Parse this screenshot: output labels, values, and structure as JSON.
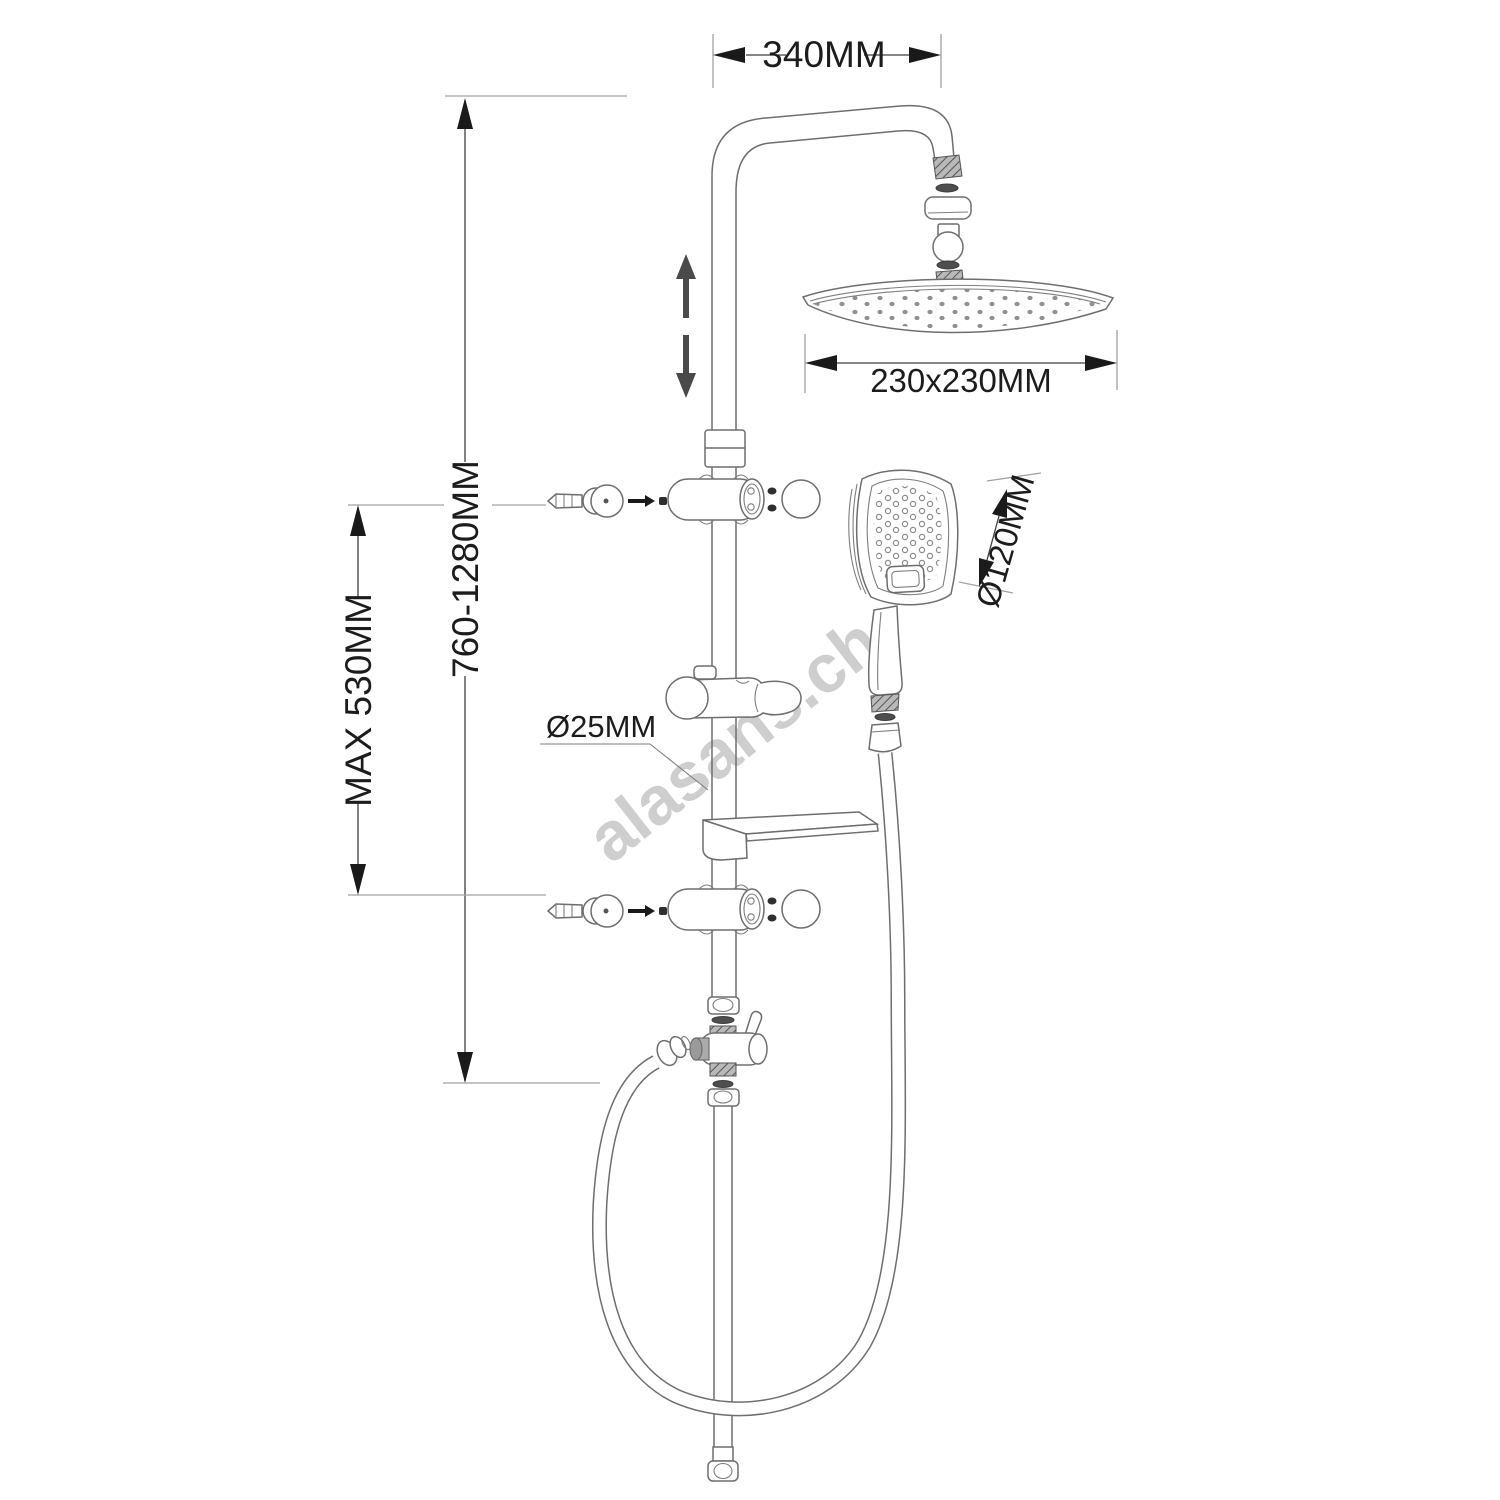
{
  "drawing": {
    "title": "shower-column-technical-drawing",
    "watermark": "alasans.ch",
    "labels": {
      "width_top": "340MM",
      "height_range": "760-1280MM",
      "max_slide": "MAX 530MM",
      "head_size": "230x230MM",
      "hand_shower_diameter": "Ø120MM",
      "pipe_diameter": "Ø25MM"
    },
    "colors": {
      "background": "#ffffff",
      "line": "#6e6e6e",
      "dimension": "#1c1c1c",
      "extension": "#a2a2a2",
      "watermark": "#c6c6c6",
      "shade": "#4e4e4e"
    }
  }
}
